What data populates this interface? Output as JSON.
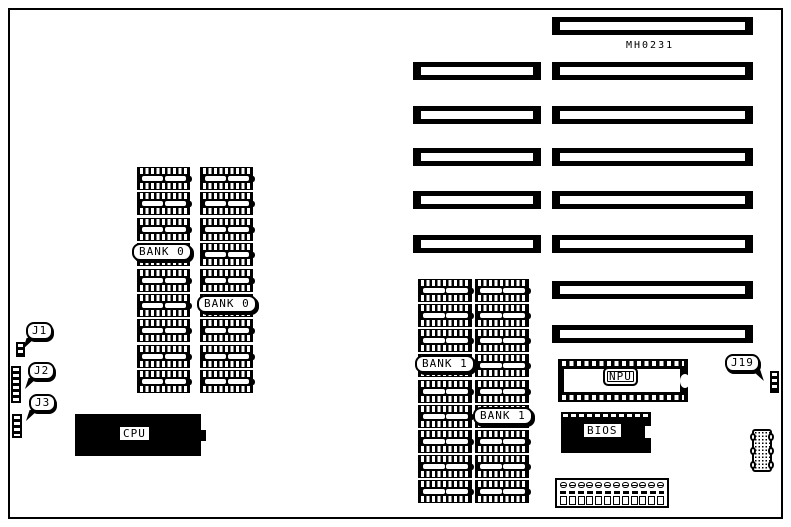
{
  "diagram": {
    "board_marking": "MH0231",
    "banks": [
      {
        "id": "bank0",
        "label": "BANK 0",
        "columns": 2,
        "label_instances": 2
      },
      {
        "id": "bank1",
        "label": "BANK 1",
        "columns": 2,
        "label_instances": 2
      }
    ],
    "memory": {
      "chips_per_column": 9
    },
    "chips": {
      "cpu": "CPU",
      "npu": "NPU",
      "bios": "BIOS"
    },
    "jumpers": [
      {
        "id": "J1"
      },
      {
        "id": "J2"
      },
      {
        "id": "J3"
      },
      {
        "id": "J19"
      }
    ],
    "slots": {
      "rows": [
        {
          "short": false,
          "long": true
        },
        {
          "short": true,
          "long": true
        },
        {
          "short": true,
          "long": true
        },
        {
          "short": true,
          "long": true
        },
        {
          "short": true,
          "long": true
        },
        {
          "short": true,
          "long": true
        },
        {
          "short": false,
          "long": true
        },
        {
          "short": false,
          "long": true
        }
      ]
    },
    "power_connector": {
      "pins": 12
    },
    "colors": {
      "foreground": "#000000",
      "background": "#ffffff"
    }
  }
}
